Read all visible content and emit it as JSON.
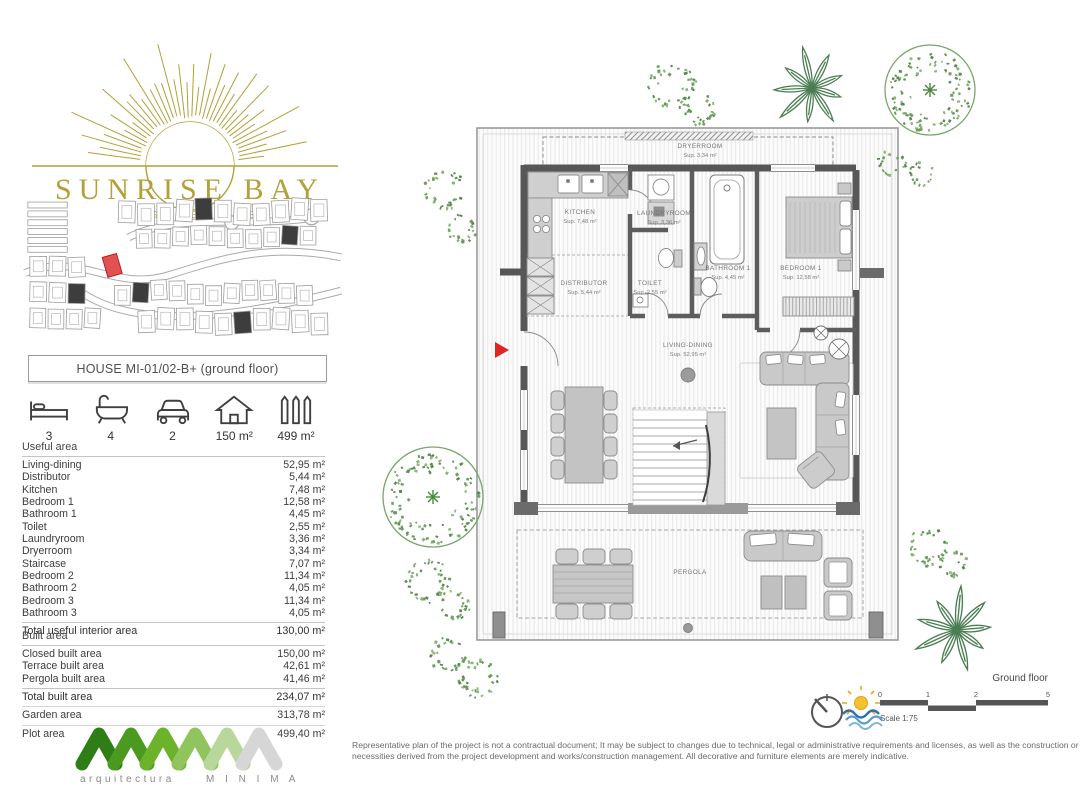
{
  "brand": {
    "name": "SUNRISE BAY",
    "subtitle": "RESIDENCES"
  },
  "plan_header": {
    "title": "HOUSE MI-01/02-B+  (ground floor)"
  },
  "stats": [
    {
      "icon": "bed-icon",
      "value": "3"
    },
    {
      "icon": "bath-icon",
      "value": "4"
    },
    {
      "icon": "car-icon",
      "value": "2"
    },
    {
      "icon": "house-icon",
      "value": "150 m²"
    },
    {
      "icon": "fence-icon",
      "value": "499 m²"
    }
  ],
  "useful_area": {
    "heading": "Useful area",
    "rows": [
      {
        "label": "Living-dining",
        "value": "52,95 m²"
      },
      {
        "label": "Distributor",
        "value": "5,44 m²"
      },
      {
        "label": "Kitchen",
        "value": "7,48 m²"
      },
      {
        "label": "Bedroom 1",
        "value": "12,58 m²"
      },
      {
        "label": "Bathroom 1",
        "value": "4,45 m²"
      },
      {
        "label": "Toilet",
        "value": "2,55 m²"
      },
      {
        "label": "Laundryroom",
        "value": "3,36 m²"
      },
      {
        "label": "Dryerroom",
        "value": "3,34 m²"
      },
      {
        "label": "Staircase",
        "value": "7,07 m²"
      },
      {
        "label": "Bedroom 2",
        "value": "11,34 m²"
      },
      {
        "label": "Bathroom 2",
        "value": "4,05 m²"
      },
      {
        "label": "Bedroom 3",
        "value": "11,34 m²"
      },
      {
        "label": "Bathroom 3",
        "value": "4,05 m²"
      }
    ],
    "total_label": "Total useful interior area",
    "total_value": "130,00 m²"
  },
  "built_area": {
    "heading": "Built area",
    "rows": [
      {
        "label": "Closed built area",
        "value": "150,00 m²"
      },
      {
        "label": "Terrace built area",
        "value": "42,61 m²"
      },
      {
        "label": "Pergola built area",
        "value": "41,46 m²"
      }
    ],
    "total_label": "Total built area",
    "total_value": "234,07 m²",
    "garden_label": "Garden area",
    "garden_value": "313,78 m²",
    "plot_label": "Plot area",
    "plot_value": "499,40 m²"
  },
  "architect": {
    "line1": "arquitectura",
    "line2": "M I N I M A"
  },
  "plan": {
    "rooms": [
      {
        "name": "DRYERROOM",
        "sup": "Sup. 3,34 m²"
      },
      {
        "name": "KITCHEN",
        "sup": "Sup. 7,48 m²"
      },
      {
        "name": "LAUNDRYROOM",
        "sup": "Sup. 3,36 m²"
      },
      {
        "name": "BATHROOM 1",
        "sup": "Sup. 4,45 m²"
      },
      {
        "name": "BEDROOM 1",
        "sup": "Sup. 12,58 m²"
      },
      {
        "name": "DISTRIBUTOR",
        "sup": "Sup. 5,44 m²"
      },
      {
        "name": "TOILET",
        "sup": "Sup. 2,55 m²"
      },
      {
        "name": "LIVING-DINING",
        "sup": "Sup. 52,95 m²"
      },
      {
        "name": "PERGOLA",
        "sup": ""
      }
    ]
  },
  "footer": {
    "floor_label": "Ground floor",
    "scale_label": "Scale 1:75",
    "scale_ticks": [
      "0",
      "1",
      "2",
      "5"
    ],
    "disclaimer_line1": "Representative plan of the project is not a contractual document; It may be subject to changes due to technical, legal or administrative requirements and licenses, as well as the construction or design",
    "disclaimer_line2": "necessities derived from the project development and works/construction management. All decorative and furniture elements are merely indicative."
  }
}
